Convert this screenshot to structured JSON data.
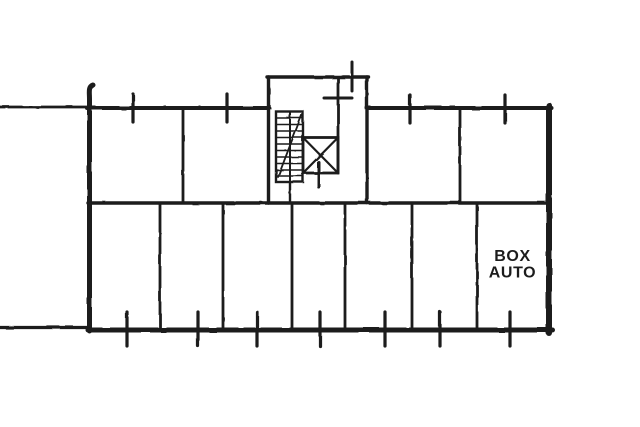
{
  "palette": {
    "background": "#ffffff",
    "ink": "#1c1c1c"
  },
  "floorplan": {
    "room_label": {
      "line1": "BOX",
      "line2": "AUTO"
    }
  }
}
